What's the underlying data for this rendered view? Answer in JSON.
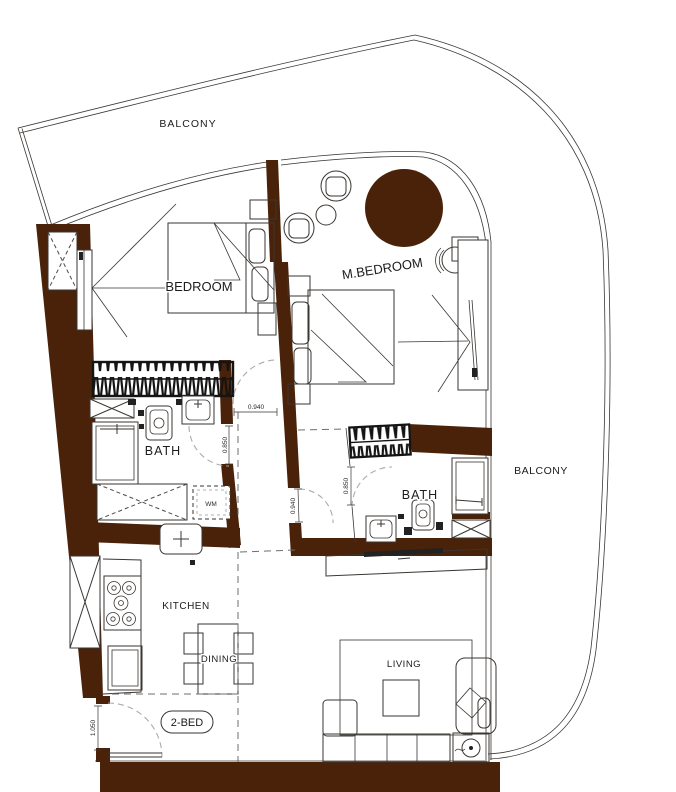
{
  "plan": {
    "badge": "2-BED",
    "rooms": {
      "balcony_top": "BALCONY",
      "balcony_right": "BALCONY",
      "bedroom": "BEDROOM",
      "master_bedroom": "M.BEDROOM",
      "bath": "BATH",
      "master_bath": "BATH",
      "kitchen": "KITCHEN",
      "dining": "DINING",
      "living": "LIVING"
    },
    "appliances": {
      "washing_machine": "WM"
    },
    "dimensions": {
      "bedroom_door": "0.940",
      "bath_door": "0.850",
      "master_bedroom_door": "0.940",
      "master_bath_door": "0.850",
      "entry_door": "1.050"
    },
    "colors": {
      "wall": "#4A2209",
      "line": "#3A3632",
      "dashed": "#9B9B9B",
      "background": "#FFFFFF"
    }
  }
}
